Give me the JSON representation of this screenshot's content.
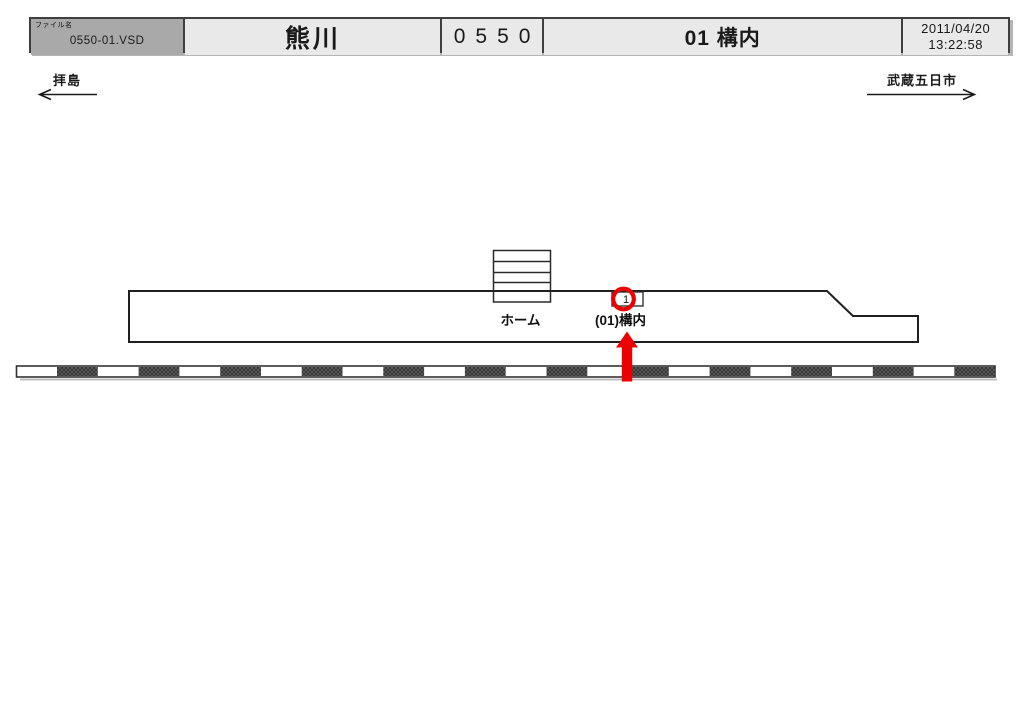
{
  "header": {
    "file_label": "ファイル名",
    "file_name": "0550-01.VSD",
    "station_name": "熊川",
    "station_code": "0550",
    "sheet_title": "01 構内",
    "date": "2011/04/20",
    "time": "13:22:58"
  },
  "directions": {
    "left": "拝島",
    "right": "武蔵五日市"
  },
  "diagram": {
    "platform_label": "ホーム",
    "track_number": "1",
    "track_label": "(01)構内"
  },
  "colors": {
    "accent_red": "#EC0000",
    "header_file_bg": "#A9A9A9",
    "header_cell_bg": "#E9E9E9",
    "border_dark": "#3F3F3F",
    "line_color": "#1F1F1F"
  }
}
